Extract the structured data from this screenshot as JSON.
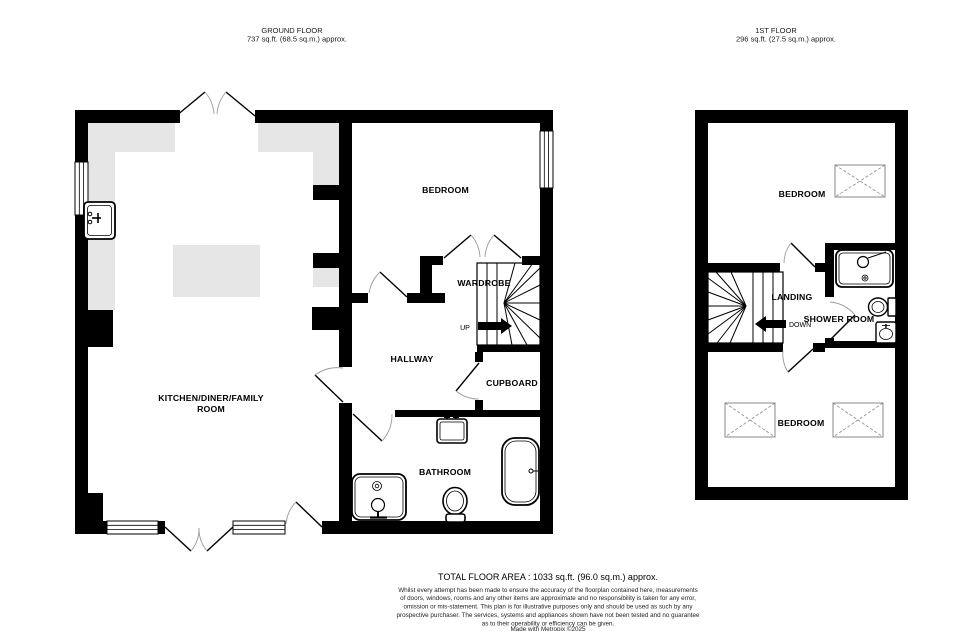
{
  "header": {
    "ground": {
      "title": "GROUND FLOOR",
      "area": "737 sq.ft. (68.5 sq.m.) approx."
    },
    "first": {
      "title": "1ST FLOOR",
      "area": "296 sq.ft. (27.5 sq.m.) approx."
    }
  },
  "ground_floor": {
    "kitchen_label_line1": "KITCHEN/DINER/FAMILY",
    "kitchen_label_line2": "ROOM",
    "bedroom": "BEDROOM",
    "wardrobe": "WARDROBE",
    "hallway": "HALLWAY",
    "cupboard": "CUPBOARD",
    "bathroom": "BATHROOM",
    "stairs_direction": "UP"
  },
  "first_floor": {
    "bedroom_front": "BEDROOM",
    "landing": "LANDING",
    "shower_room": "SHOWER ROOM",
    "bedroom_back": "BEDROOM",
    "stairs_direction": "DOWN"
  },
  "footer": {
    "total_area": "TOTAL FLOOR AREA : 1033 sq.ft. (96.0 sq.m.) approx.",
    "disclaimer": [
      "Whilst every attempt has been made to ensure the accuracy of the floorplan contained here, measurements",
      "of doors, windows, rooms and any other items are approximate and no responsibility is taken for any error,",
      "omission or mis-statement. This plan is for illustrative purposes only and should be used as such by any",
      "prospective purchaser. The services, systems and appliances shown have not been tested and no guarantee",
      "as to their operability or efficiency can be given.",
      "Made with Metropix ©2025"
    ]
  },
  "colors": {
    "wall": "#000000",
    "counter": "#e6e6e6",
    "background": "#ffffff",
    "velux_outline": "#8a8a8a",
    "door_arc": "#9b9b9b"
  }
}
